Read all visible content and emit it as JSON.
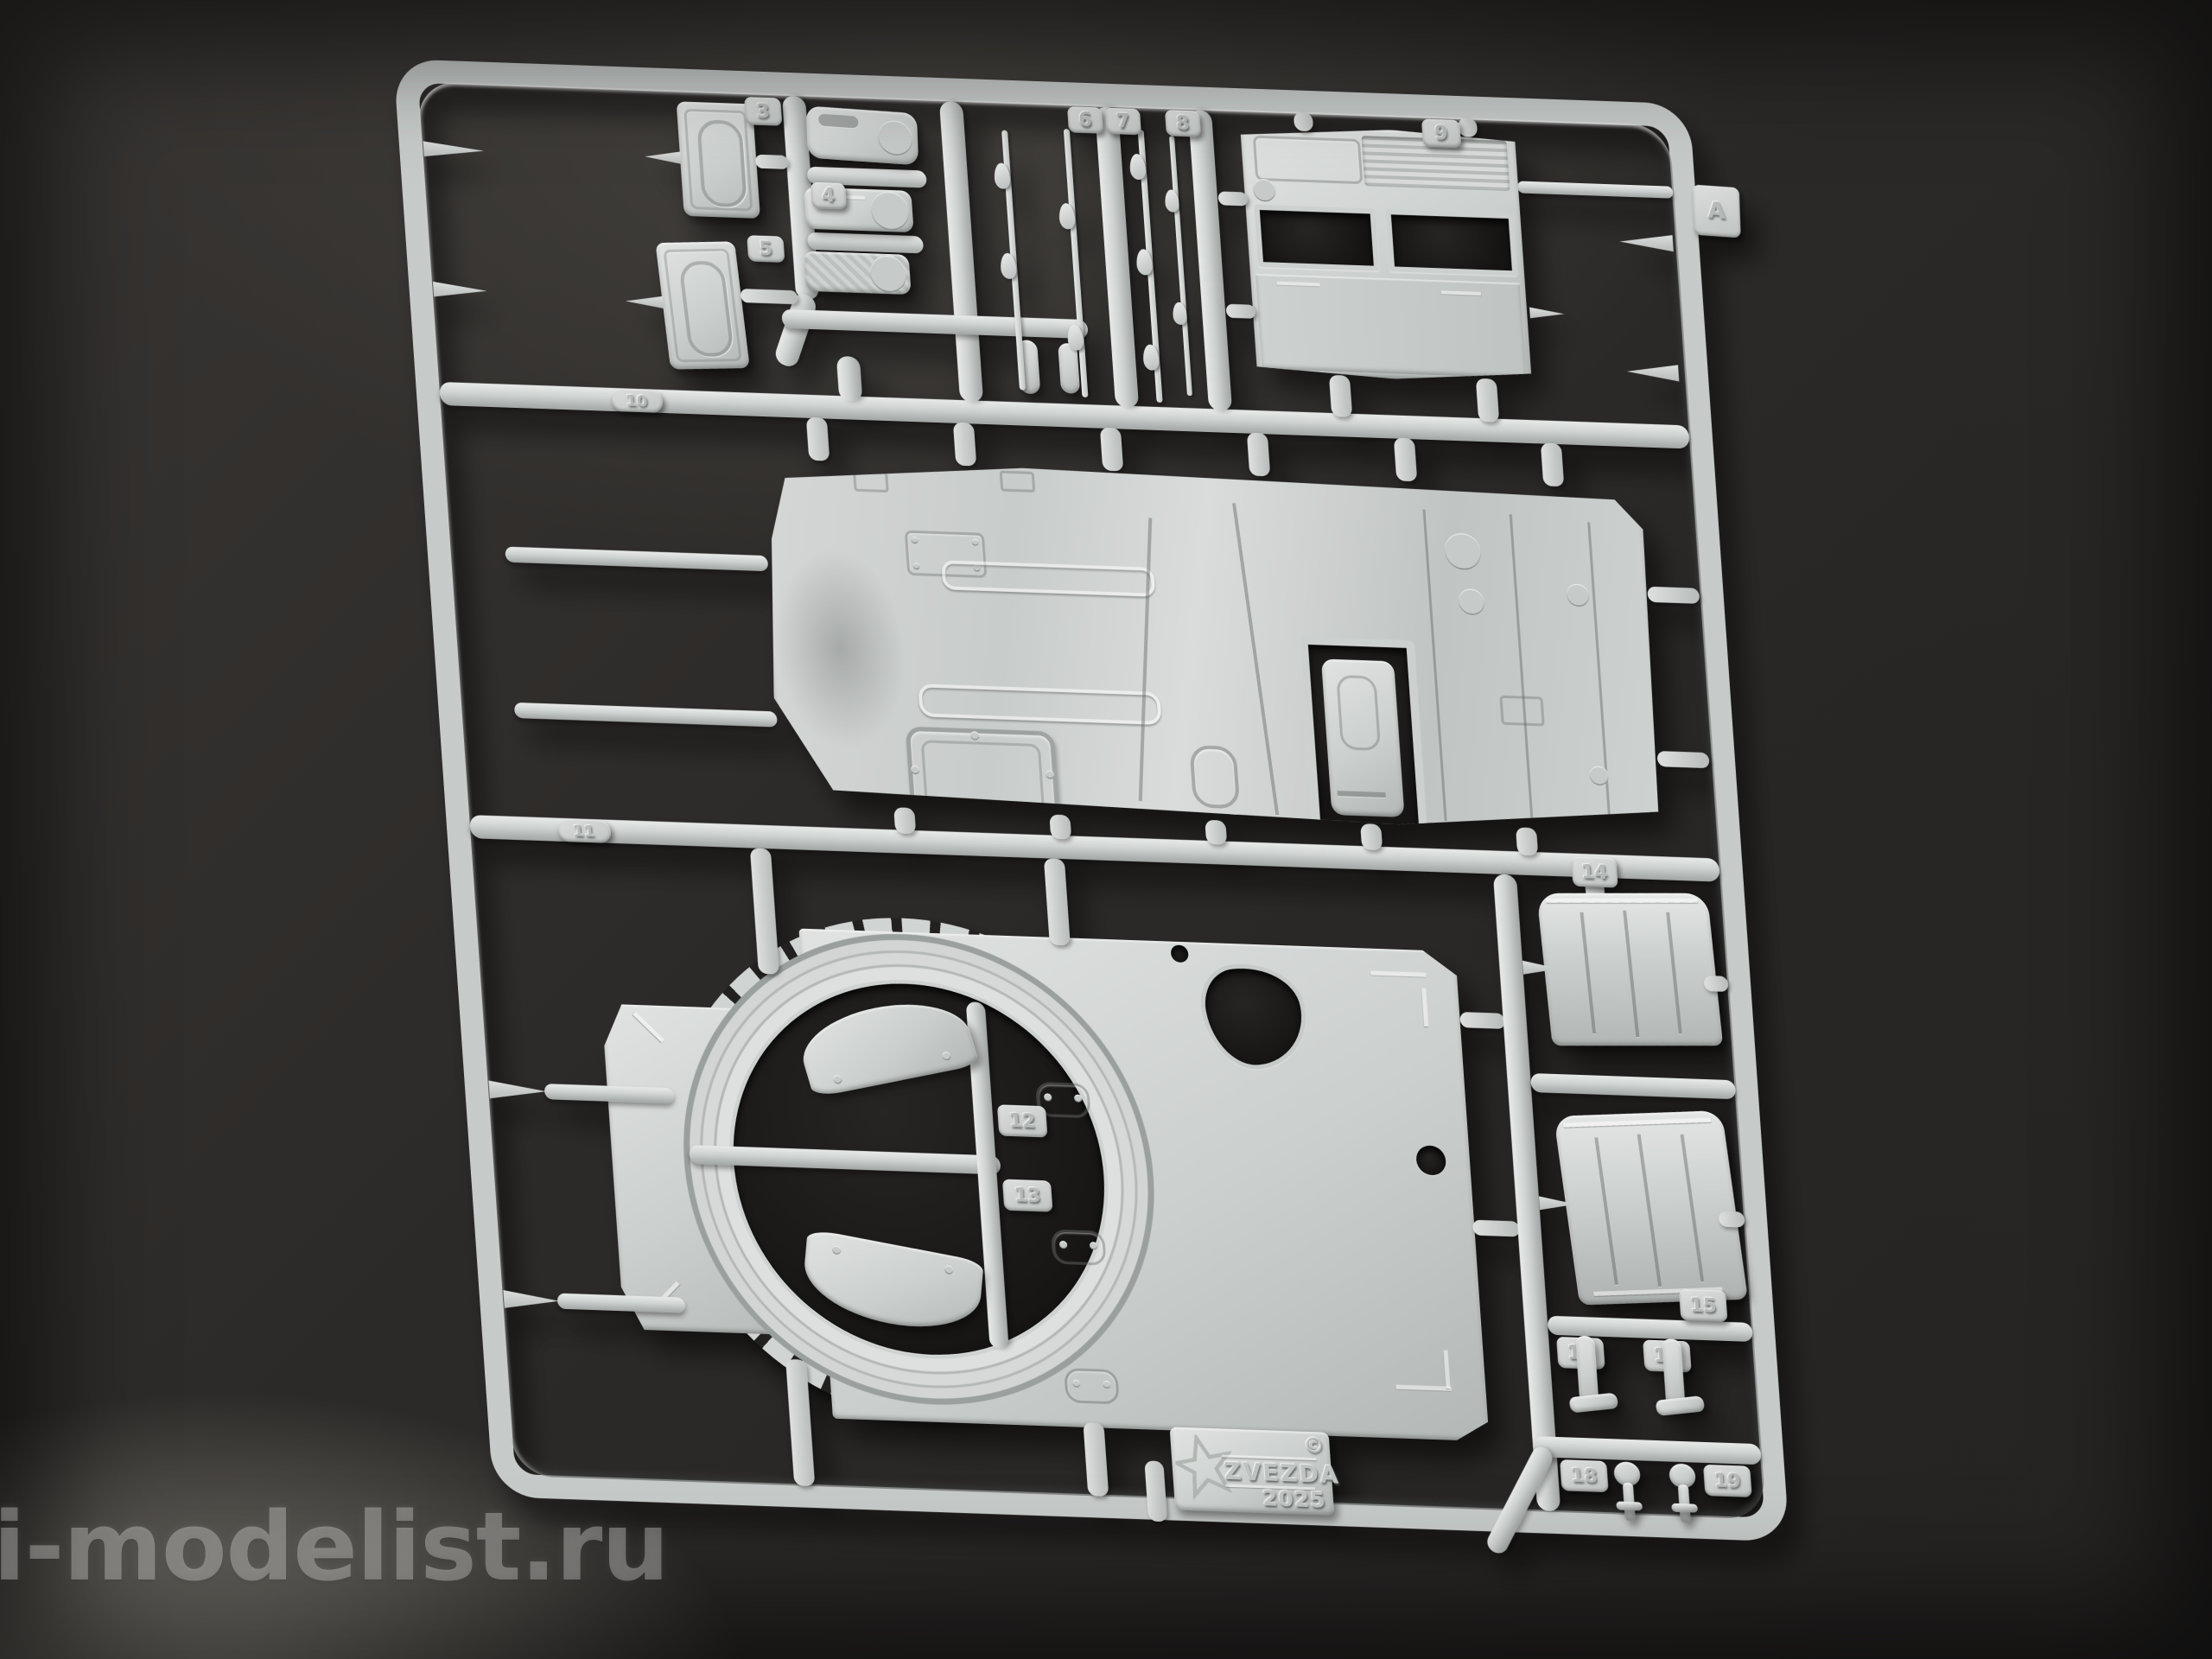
{
  "scene": {
    "watermark_text": "i-modelist.ru",
    "background_color": "#2b2927",
    "plastic_color": "#c9cdcb"
  },
  "sprue": {
    "letter_tab": "A",
    "maker_plate": {
      "copyright_symbol": "©",
      "brand": "ZVEZDA",
      "year": "2025"
    },
    "part_tags": [
      "3",
      "4",
      "5",
      "6",
      "7",
      "8",
      "9",
      "10",
      "11",
      "12",
      "13",
      "14",
      "15",
      "16",
      "17",
      "18",
      "19"
    ]
  }
}
